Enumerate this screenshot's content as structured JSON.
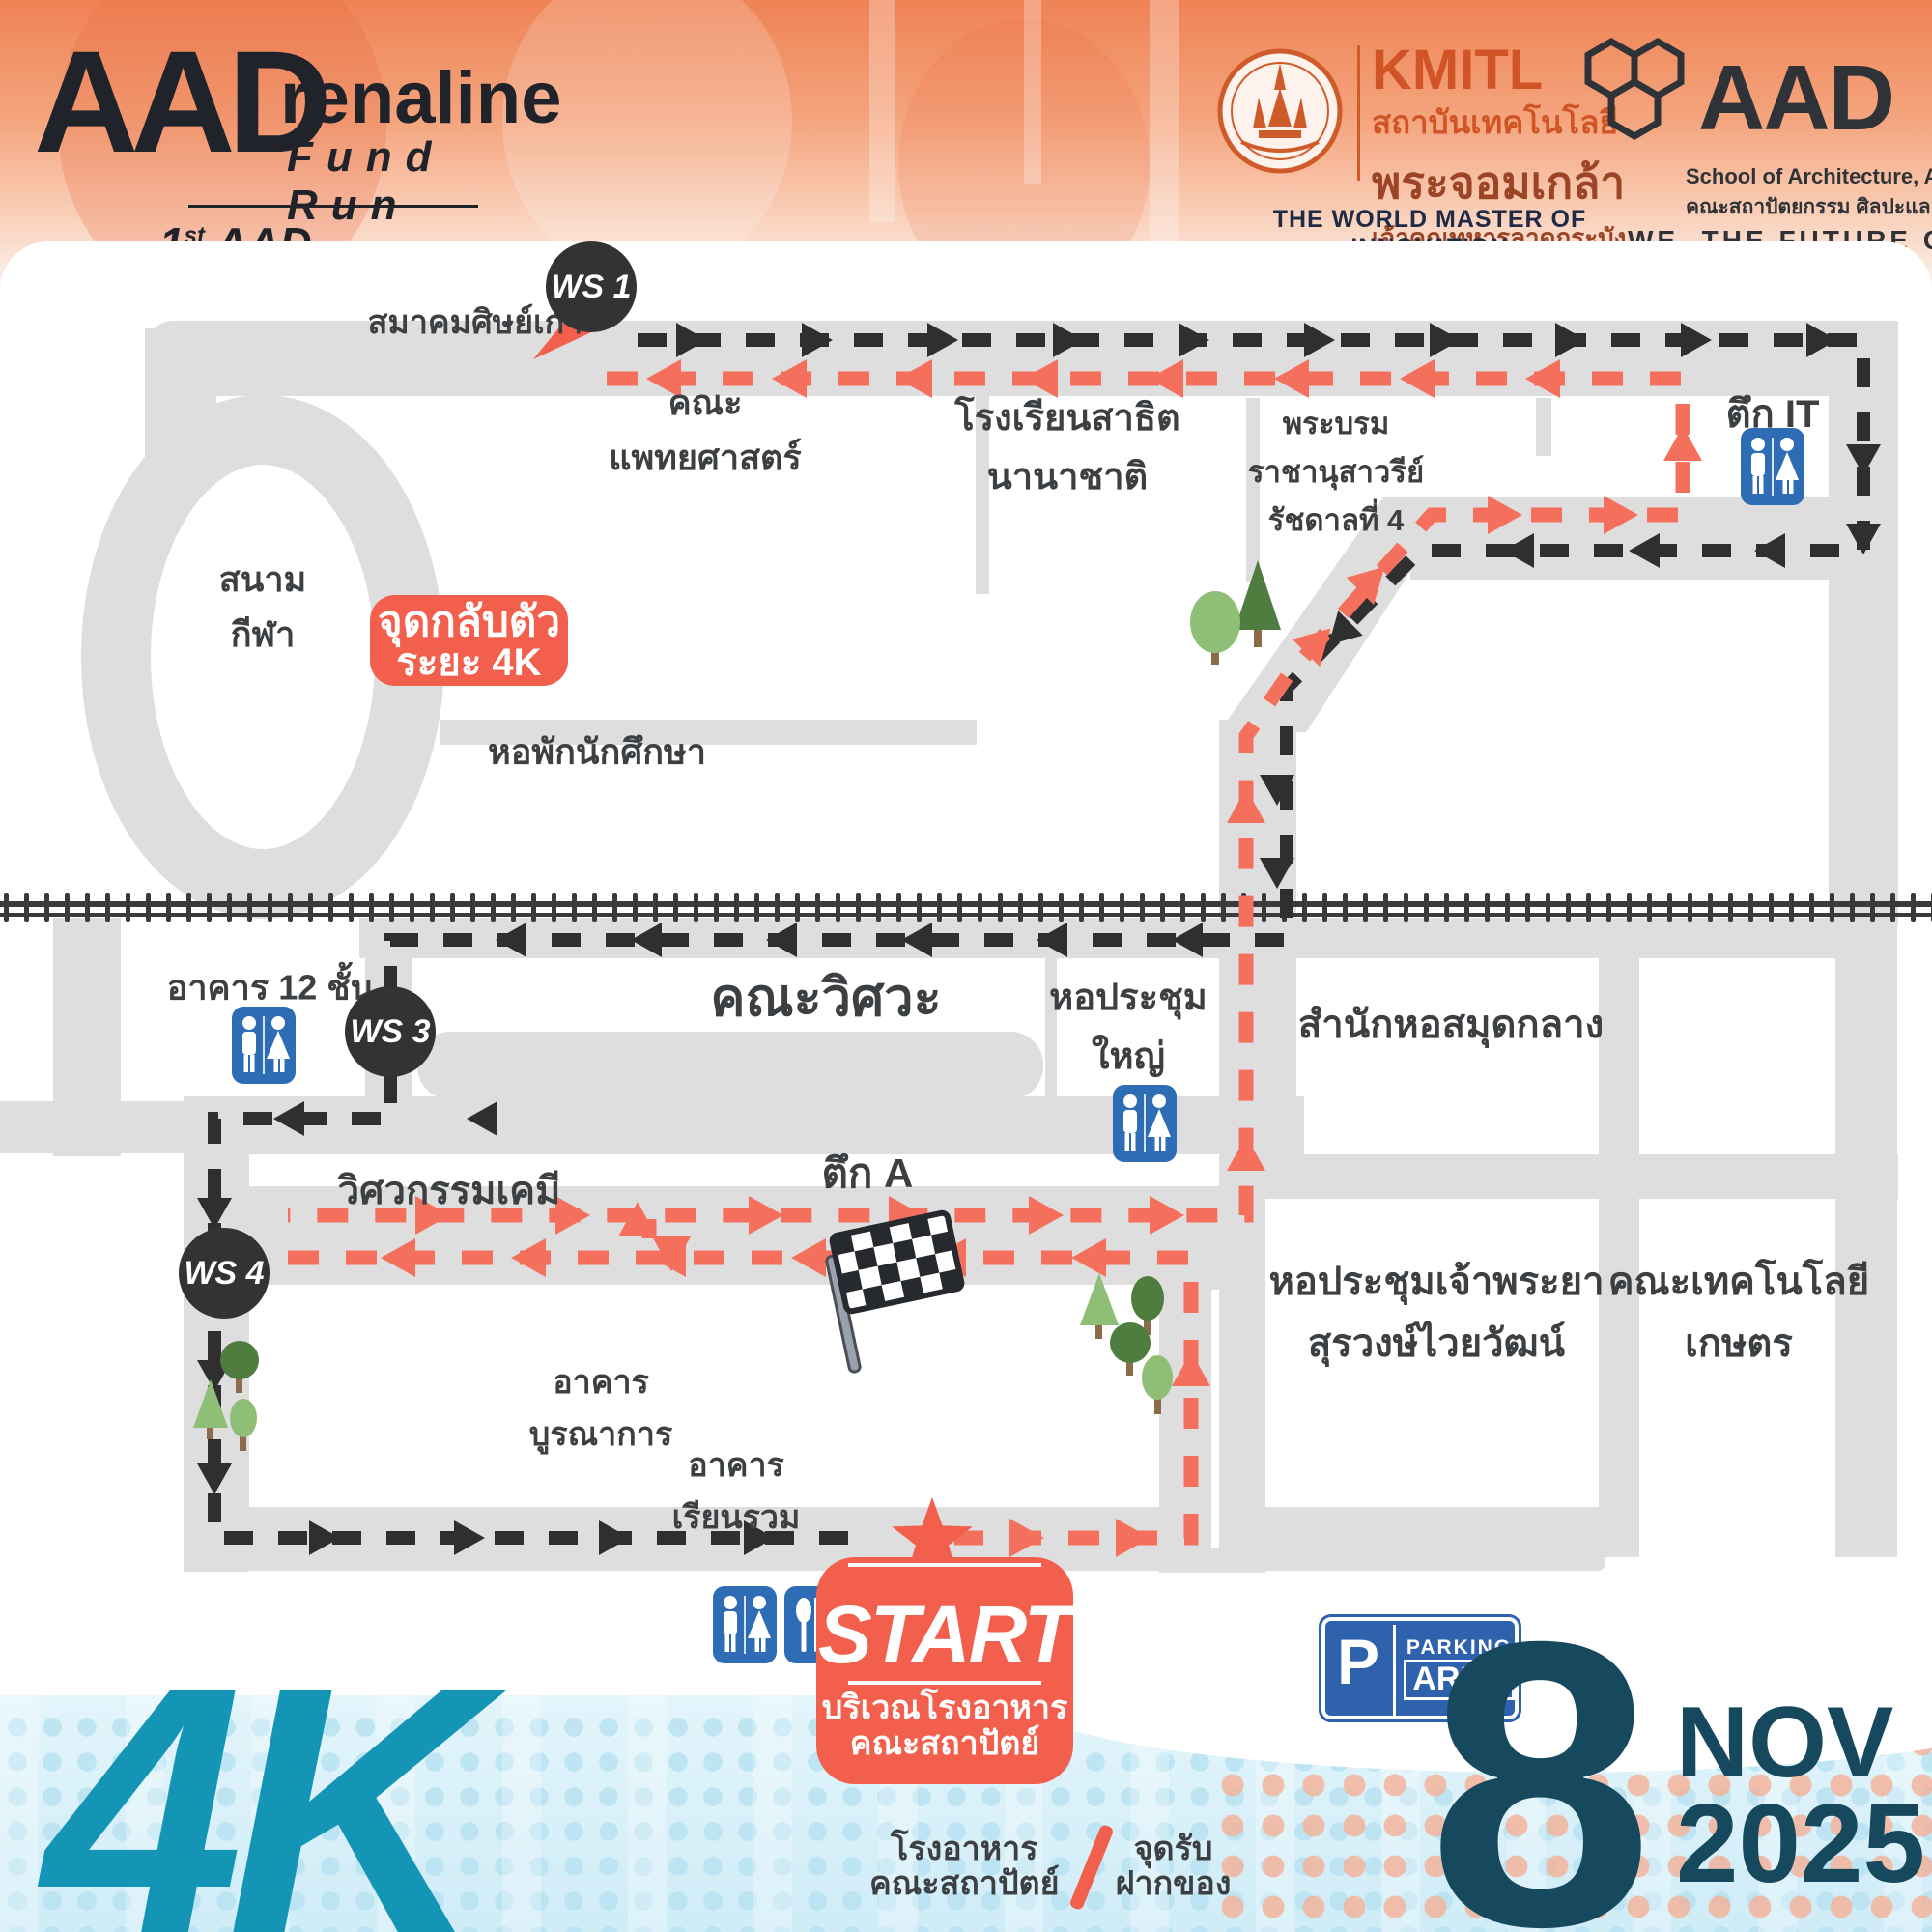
{
  "header": {
    "logo": {
      "aad": "AAD",
      "renaline": "renaline",
      "fund_run": "Fund Run",
      "tagline_num": "1",
      "tagline_sup": "st",
      "tagline_rest": " AAD Charity Run"
    },
    "kmitl": {
      "name": "KMITL",
      "line1": "สถาบันเทคโนโลยี",
      "line2": "พระจอมเกล้า",
      "line3": "เจ้าคุณทหารลาดกระบัง",
      "motto": "THE WORLD MASTER OF INNOVATION"
    },
    "aad_school": {
      "name": "AAD",
      "line1": "School of Architecture, Art, and Design",
      "line2": "คณะสถาปัตยกรรม ศิลปะและการออกแบบ",
      "motto": "WE, THE FUTURE CREATOR"
    }
  },
  "map": {
    "turn_badge": {
      "line1": "จุดกลับตัว",
      "line2": "ระยะ 4K"
    },
    "waypoints": {
      "ws1": "WS 1",
      "ws3": "WS 3",
      "ws4": "WS 4"
    },
    "labels": {
      "alumni": "สมาคมศิษย์เก่า",
      "medicine1": "คณะ",
      "medicine2": "แพทยศาสตร์",
      "satit1": "โรงเรียนสาธิต",
      "satit2": "นานาชาติ",
      "monument1": "พระบรม",
      "monument2": "ราชานุสาวรีย์",
      "monument3": "รัชดาลที่ 4",
      "it_building": "ตึก IT",
      "stadium1": "สนาม",
      "stadium2": "กีฬา",
      "dorm": "หอพักนักศึกษา",
      "b12": "อาคาร 12 ชั้น",
      "engineering": "คณะวิศวะ",
      "grand_aud1": "หอประชุม",
      "grand_aud2": "ใหญ่",
      "library": "สำนักหอสมุดกลาง",
      "building_a": "ตึก A",
      "chem_eng": "วิศวกรรมเคมี",
      "chao_aud1": "หอประชุมเจ้าพระยา",
      "chao_aud2": "สุรวงษ์ไวยวัฒน์",
      "agri_tech1": "คณะเทคโนโลยี",
      "agri_tech2": "เกษตร",
      "integrated1": "อาคาร",
      "integrated2": "บูรณาการ",
      "learning1": "อาคาร",
      "learning2": "เรียนรวม"
    },
    "start": {
      "title": "START",
      "line1": "บริเวณโรงอาหาร",
      "line2": "คณะสถาปัตย์"
    },
    "parking": {
      "p": "P",
      "line1": "PARKING",
      "line2": "AREA"
    }
  },
  "legend": {
    "cafeteria1": "โรงอาหาร",
    "cafeteria2": "คณะสถาปัตย์",
    "deposit1": "จุดรับ",
    "deposit2": "ฝากของ"
  },
  "footer": {
    "distance": "4K",
    "day": "8",
    "month": "NOV",
    "year": "2025"
  },
  "colors": {
    "route_red": "#f4705c",
    "route_black": "#2f2f2f",
    "badge_red": "#f2604d",
    "road_gray": "#dedede",
    "sign_blue": "#2e6db5",
    "teal": "#1495b6",
    "dark_teal": "#17495e"
  }
}
